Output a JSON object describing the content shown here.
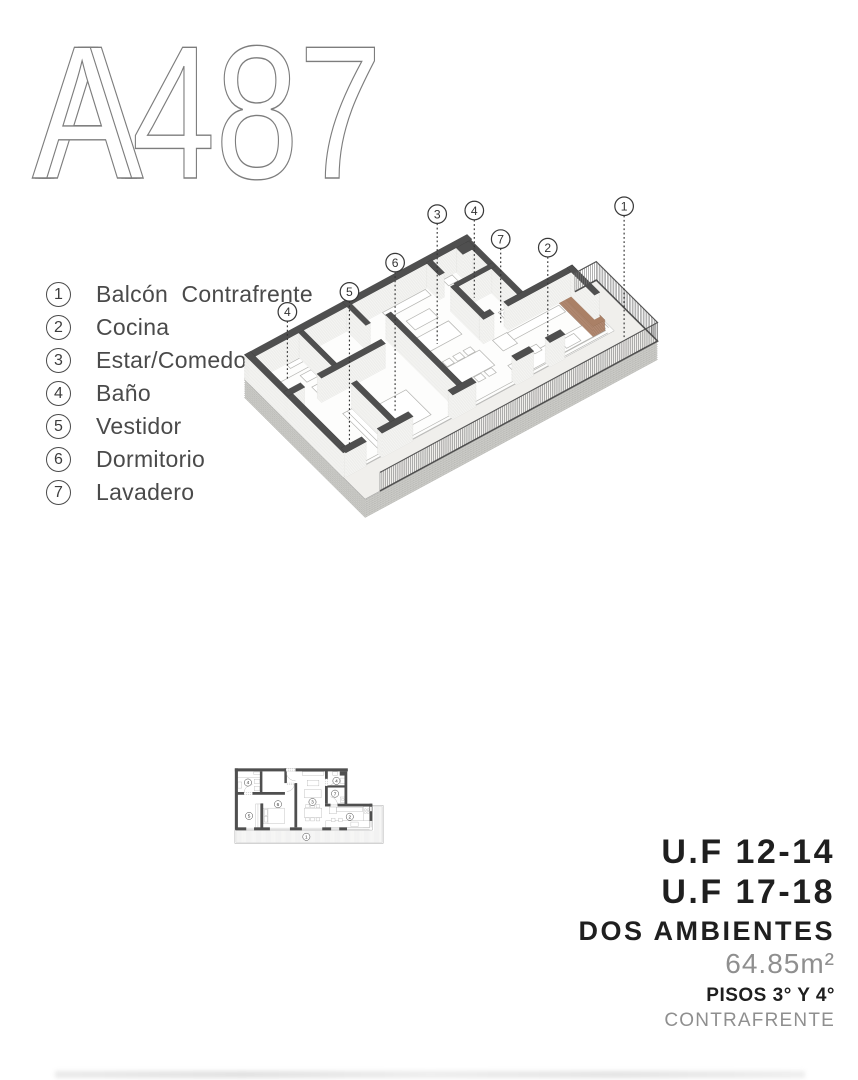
{
  "title": "A487",
  "title_initial": "A",
  "legend": {
    "items": [
      {
        "num": "1",
        "label": "Balcón  Contrafrente"
      },
      {
        "num": "2",
        "label": "Cocina"
      },
      {
        "num": "3",
        "label": "Estar/Comedor"
      },
      {
        "num": "4",
        "label": "Baño"
      },
      {
        "num": "5",
        "label": "Vestidor"
      },
      {
        "num": "6",
        "label": "Dormitorio"
      },
      {
        "num": "7",
        "label": "Lavadero"
      }
    ]
  },
  "iso_callouts": [
    {
      "num": "4",
      "x": 298,
      "y": 360,
      "end": 455
    },
    {
      "num": "5",
      "x": 385,
      "y": 332,
      "end": 545
    },
    {
      "num": "6",
      "x": 449,
      "y": 291,
      "end": 500
    },
    {
      "num": "3",
      "x": 508,
      "y": 223,
      "end": 405
    },
    {
      "num": "4",
      "x": 560,
      "y": 218,
      "end": 340
    },
    {
      "num": "7",
      "x": 597,
      "y": 258,
      "end": 375
    },
    {
      "num": "2",
      "x": 663,
      "y": 270,
      "end": 400
    },
    {
      "num": "1",
      "x": 770,
      "y": 212,
      "end": 398
    }
  ],
  "plan_callouts": [
    {
      "num": "4",
      "x": 80,
      "y": 828
    },
    {
      "num": "4",
      "x": 398,
      "y": 822
    },
    {
      "num": "7",
      "x": 393,
      "y": 868
    },
    {
      "num": "6",
      "x": 188,
      "y": 906
    },
    {
      "num": "3",
      "x": 312,
      "y": 898
    },
    {
      "num": "5",
      "x": 84,
      "y": 948
    },
    {
      "num": "2",
      "x": 446,
      "y": 951
    },
    {
      "num": "1",
      "x": 290,
      "y": 1023
    }
  ],
  "info_panel": {
    "uf_1": "U.F 12-14",
    "uf_2": "U.F 17-18",
    "type": "DOS AMBIENTES",
    "area": "64.85m²",
    "floors": "PISOS 3° Y 4°",
    "orientation": "CONTRAFRENTE"
  },
  "colors": {
    "wall": "#4f4f4f",
    "accent_counter": "#b98f77",
    "concrete": "#cbcbc7",
    "line": "#9a9a9a"
  }
}
